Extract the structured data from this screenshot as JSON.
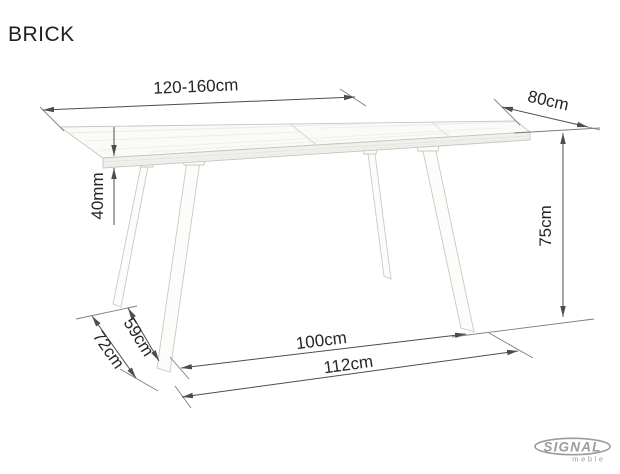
{
  "title": "BRICK",
  "diagram": {
    "type": "table-dimension-drawing",
    "dimensions": {
      "table_length": "120-160cm",
      "table_depth": "80cm",
      "top_thickness": "40mm",
      "table_height": "75cm",
      "leg_span_depth_inner": "59cm",
      "leg_span_depth_outer": "72cm",
      "leg_span_width_inner": "100cm",
      "leg_span_width_outer": "112cm"
    }
  },
  "logo": {
    "brand": "SIGNAL",
    "sub": "meble"
  },
  "colors": {
    "dimension_line": "#4d4d4d",
    "text": "#262626",
    "logo_gray": "#9c9c9c",
    "wood_light": "#fafaf7"
  }
}
